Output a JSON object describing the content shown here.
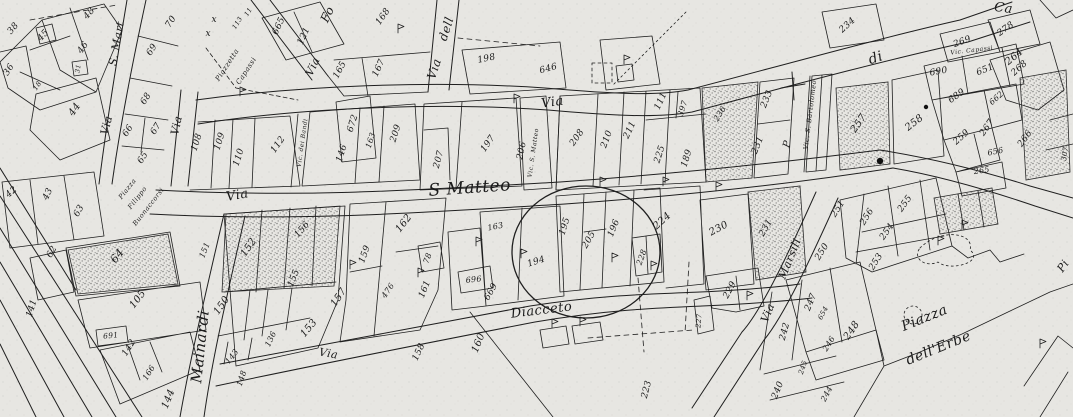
{
  "map": {
    "kind": "scanned cadastral town map",
    "colors": {
      "paper": "#e7e6e2",
      "ink": "#1f1f1f"
    },
    "annotations": {
      "highlight_circle": {
        "encircles": [
          "194",
          "195",
          "205",
          "196"
        ]
      },
      "marks": [
        "x",
        "x",
        "cross",
        "black-dot"
      ]
    },
    "labels": [
      [
        "S. Mart",
        120,
        44,
        -80,
        11,
        "street"
      ],
      [
        "Via",
        110,
        126,
        -76,
        11,
        "street"
      ],
      [
        "Via",
        180,
        126,
        -78,
        11,
        "street"
      ],
      [
        "Via",
        238,
        199,
        -10,
        13,
        "street"
      ],
      [
        "S Matteo",
        470,
        193,
        -4,
        17,
        "street"
      ],
      [
        "Via",
        553,
        106,
        -8,
        13,
        "street"
      ],
      [
        "di",
        877,
        62,
        -18,
        14,
        "street"
      ],
      [
        "Ca",
        1003,
        12,
        8,
        13,
        "street"
      ],
      [
        "Via",
        438,
        70,
        -72,
        12,
        "street"
      ],
      [
        "dell",
        450,
        30,
        -72,
        12,
        "street"
      ],
      [
        "Via",
        316,
        68,
        -65,
        11,
        "street"
      ],
      [
        "Fo",
        331,
        16,
        -65,
        12,
        "street"
      ],
      [
        "Piazzetta",
        229,
        66,
        -57,
        7,
        "street"
      ],
      [
        "Capassi",
        248,
        72,
        -57,
        7,
        "street"
      ],
      [
        "Vic. dei Bandi",
        304,
        143,
        -82,
        6,
        "street"
      ],
      [
        "Vic. S. Matteo",
        535,
        153,
        -82,
        6,
        "street"
      ],
      [
        "Vic. S. Bartolomeo",
        812,
        115,
        -83,
        6.5,
        "street"
      ],
      [
        "Vic. Capassi",
        972,
        52,
        -7,
        6,
        "street"
      ],
      [
        "Mainardi",
        205,
        347,
        -84,
        15,
        "street"
      ],
      [
        "Piazza",
        129,
        190,
        -52,
        6.5,
        "street"
      ],
      [
        "Filippo",
        139,
        199,
        -52,
        6.5,
        "street"
      ],
      [
        "Buonaccorsi",
        150,
        208,
        -52,
        6.5,
        "street"
      ],
      [
        "Via",
        328,
        357,
        10,
        11,
        "street"
      ],
      [
        "Diacceto",
        542,
        314,
        -7,
        13,
        "street"
      ],
      [
        "Via",
        771,
        314,
        -68,
        11,
        "street"
      ],
      [
        "Marsili",
        793,
        260,
        -68,
        11,
        "street"
      ],
      [
        "Piazza",
        926,
        322,
        -22,
        14,
        "street"
      ],
      [
        "dell'Erbe",
        940,
        352,
        -22,
        14,
        "street"
      ],
      [
        "Pi",
        1066,
        268,
        -55,
        11,
        "street"
      ],
      [
        "x",
        214,
        22,
        0,
        9,
        "note"
      ],
      [
        "x",
        208,
        36,
        0,
        9,
        "note"
      ],
      [
        "P",
        790,
        145,
        -75,
        10,
        "note"
      ],
      [
        "38",
        15,
        30,
        -50,
        9,
        "parcel"
      ],
      [
        "48",
        91,
        15,
        -48,
        9,
        "parcel"
      ],
      [
        "45",
        45,
        37,
        -48,
        9,
        "parcel"
      ],
      [
        "46",
        85,
        49,
        -55,
        9,
        "parcel"
      ],
      [
        "31",
        80,
        69,
        -80,
        6.5,
        "parcel"
      ],
      [
        "36",
        11,
        71,
        -58,
        9,
        "parcel"
      ],
      [
        "18",
        39,
        87,
        -55,
        7,
        "parcel"
      ],
      [
        "44",
        77,
        111,
        -55,
        10,
        "parcel"
      ],
      [
        "70",
        173,
        23,
        -58,
        9,
        "parcel"
      ],
      [
        "69",
        154,
        51,
        -58,
        9,
        "parcel"
      ],
      [
        "68",
        148,
        100,
        -58,
        9,
        "parcel"
      ],
      [
        "66",
        130,
        132,
        -58,
        9,
        "parcel"
      ],
      [
        "67",
        158,
        130,
        -58,
        9,
        "parcel"
      ],
      [
        "65",
        145,
        159,
        -58,
        9,
        "parcel"
      ],
      [
        "42",
        13,
        194,
        -40,
        9,
        "parcel"
      ],
      [
        "43",
        50,
        195,
        -65,
        9,
        "parcel"
      ],
      [
        "63",
        81,
        212,
        -60,
        9,
        "parcel"
      ],
      [
        "62",
        54,
        253,
        -60,
        9,
        "parcel"
      ],
      [
        "64",
        120,
        258,
        -52,
        11,
        "parcel"
      ],
      [
        "141",
        34,
        309,
        -72,
        9,
        "parcel"
      ],
      [
        "105",
        140,
        301,
        -52,
        10,
        "parcel"
      ],
      [
        "691",
        111,
        338,
        -6,
        7.5,
        "parcel"
      ],
      [
        "142",
        131,
        349,
        -58,
        9,
        "parcel"
      ],
      [
        "166",
        151,
        374,
        -58,
        8,
        "parcel"
      ],
      [
        "144",
        171,
        400,
        -68,
        10,
        "parcel"
      ],
      [
        "108",
        199,
        143,
        -72,
        9,
        "parcel"
      ],
      [
        "109",
        222,
        142,
        -72,
        9,
        "parcel"
      ],
      [
        "110",
        241,
        158,
        -72,
        9,
        "parcel"
      ],
      [
        "112",
        280,
        146,
        -55,
        9,
        "parcel"
      ],
      [
        "113",
        239,
        24,
        -58,
        6.5,
        "parcel"
      ],
      [
        "11",
        250,
        13,
        -58,
        6.5,
        "parcel"
      ],
      [
        "665",
        281,
        27,
        -65,
        9,
        "parcel"
      ],
      [
        "121",
        306,
        37,
        -65,
        9,
        "parcel"
      ],
      [
        "168",
        385,
        18,
        -55,
        9,
        "parcel"
      ],
      [
        "165",
        342,
        71,
        -62,
        9,
        "parcel"
      ],
      [
        "167",
        381,
        69,
        -65,
        9,
        "parcel"
      ],
      [
        "672",
        355,
        124,
        -72,
        9,
        "parcel"
      ],
      [
        "146",
        344,
        154,
        -72,
        9,
        "parcel"
      ],
      [
        "163",
        373,
        141,
        -72,
        8,
        "parcel"
      ],
      [
        "209",
        398,
        134,
        -72,
        9,
        "parcel"
      ],
      [
        "207",
        441,
        160,
        -75,
        9,
        "parcel"
      ],
      [
        "197",
        490,
        145,
        -55,
        9,
        "parcel"
      ],
      [
        "198",
        487,
        61,
        -12,
        9,
        "parcel"
      ],
      [
        "646",
        549,
        71,
        -15,
        9,
        "parcel"
      ],
      [
        "206",
        524,
        151,
        -78,
        9,
        "parcel"
      ],
      [
        "208",
        579,
        139,
        -55,
        9,
        "parcel"
      ],
      [
        "210",
        609,
        140,
        -70,
        9,
        "parcel"
      ],
      [
        "211",
        632,
        131,
        -65,
        9,
        "parcel"
      ],
      [
        "225",
        662,
        155,
        -72,
        9,
        "parcel"
      ],
      [
        "189",
        689,
        159,
        -72,
        9,
        "parcel"
      ],
      [
        "111",
        663,
        102,
        -65,
        9,
        "parcel"
      ],
      [
        "397",
        685,
        109,
        -72,
        8,
        "parcel"
      ],
      [
        "236",
        722,
        115,
        -58,
        8,
        "parcel"
      ],
      [
        "233",
        769,
        100,
        -68,
        9,
        "parcel"
      ],
      [
        "231",
        760,
        146,
        -68,
        9,
        "parcel"
      ],
      [
        "234",
        849,
        27,
        -42,
        9,
        "parcel"
      ],
      [
        "269",
        963,
        44,
        -20,
        9,
        "parcel"
      ],
      [
        "278",
        1007,
        31,
        -35,
        9,
        "parcel"
      ],
      [
        "690",
        939,
        74,
        -10,
        9,
        "parcel"
      ],
      [
        "651",
        986,
        72,
        -22,
        9,
        "parcel"
      ],
      [
        "689",
        958,
        98,
        -35,
        9,
        "parcel"
      ],
      [
        "268",
        1021,
        70,
        -42,
        9,
        "parcel"
      ],
      [
        "662",
        998,
        100,
        -42,
        8,
        "parcel"
      ],
      [
        "267",
        989,
        129,
        -55,
        9,
        "parcel"
      ],
      [
        "259",
        963,
        139,
        -42,
        9,
        "parcel"
      ],
      [
        "656",
        996,
        154,
        -12,
        8,
        "parcel"
      ],
      [
        "266",
        1027,
        140,
        -55,
        9,
        "parcel"
      ],
      [
        "265",
        982,
        173,
        -8,
        8,
        "parcel"
      ],
      [
        "258",
        916,
        125,
        -38,
        10,
        "parcel"
      ],
      [
        "257",
        861,
        125,
        -55,
        10,
        "parcel"
      ],
      [
        "264",
        1016,
        59,
        -40,
        10,
        "parcel"
      ],
      [
        "307",
        1067,
        154,
        -82,
        7,
        "parcel"
      ],
      [
        "162",
        406,
        225,
        -52,
        10,
        "parcel"
      ],
      [
        "159",
        367,
        255,
        -70,
        9,
        "parcel"
      ],
      [
        "476",
        390,
        292,
        -55,
        8,
        "parcel"
      ],
      [
        "161",
        427,
        290,
        -68,
        9,
        "parcel"
      ],
      [
        "78",
        430,
        259,
        -70,
        8,
        "parcel"
      ],
      [
        "696",
        474,
        282,
        -6,
        8,
        "parcel"
      ],
      [
        "669",
        493,
        293,
        -60,
        9,
        "parcel"
      ],
      [
        "194",
        537,
        264,
        -18,
        9,
        "parcel"
      ],
      [
        "163",
        496,
        229,
        -12,
        8,
        "parcel"
      ],
      [
        "195",
        567,
        227,
        -72,
        9,
        "parcel"
      ],
      [
        "205",
        591,
        241,
        -60,
        9,
        "parcel"
      ],
      [
        "196",
        616,
        229,
        -68,
        9,
        "parcel"
      ],
      [
        "224",
        664,
        223,
        -42,
        10,
        "parcel"
      ],
      [
        "228",
        644,
        258,
        -70,
        8,
        "parcel"
      ],
      [
        "230",
        720,
        231,
        -28,
        10,
        "parcel"
      ],
      [
        "231",
        768,
        229,
        -60,
        9,
        "parcel"
      ],
      [
        "229",
        732,
        291,
        -62,
        9,
        "parcel"
      ],
      [
        "227",
        701,
        321,
        -85,
        7,
        "parcel"
      ],
      [
        "250",
        824,
        253,
        -58,
        9,
        "parcel"
      ],
      [
        "251",
        840,
        210,
        -58,
        9,
        "parcel"
      ],
      [
        "256",
        869,
        218,
        -58,
        9,
        "parcel"
      ],
      [
        "255",
        907,
        205,
        -55,
        9,
        "parcel"
      ],
      [
        "254",
        889,
        233,
        -55,
        9,
        "parcel"
      ],
      [
        "253",
        878,
        263,
        -58,
        9,
        "parcel"
      ],
      [
        "247",
        813,
        303,
        -68,
        9,
        "parcel"
      ],
      [
        "654",
        825,
        314,
        -62,
        7,
        "parcel"
      ],
      [
        "242",
        787,
        332,
        -75,
        9,
        "parcel"
      ],
      [
        "246",
        831,
        345,
        -58,
        8,
        "parcel"
      ],
      [
        "248",
        854,
        332,
        -55,
        10,
        "parcel"
      ],
      [
        "245",
        805,
        368,
        -72,
        7,
        "parcel"
      ],
      [
        "240",
        780,
        391,
        -68,
        9,
        "parcel"
      ],
      [
        "244",
        829,
        395,
        -62,
        8,
        "parcel"
      ],
      [
        "150",
        224,
        307,
        -55,
        10,
        "parcel"
      ],
      [
        "151",
        207,
        251,
        -68,
        8,
        "parcel"
      ],
      [
        "152",
        251,
        249,
        -55,
        10,
        "parcel"
      ],
      [
        "156",
        304,
        231,
        -50,
        9,
        "parcel"
      ],
      [
        "155",
        296,
        279,
        -68,
        9,
        "parcel"
      ],
      [
        "157",
        341,
        299,
        -55,
        10,
        "parcel"
      ],
      [
        "153",
        311,
        330,
        -50,
        10,
        "parcel"
      ],
      [
        "143",
        234,
        358,
        -52,
        8,
        "parcel"
      ],
      [
        "148",
        244,
        379,
        -72,
        8,
        "parcel"
      ],
      [
        "136",
        273,
        340,
        -65,
        8,
        "parcel"
      ],
      [
        "158",
        421,
        353,
        -65,
        9,
        "parcel"
      ],
      [
        "160",
        481,
        344,
        -68,
        10,
        "parcel"
      ],
      [
        "223",
        649,
        390,
        -76,
        9,
        "parcel"
      ]
    ]
  }
}
